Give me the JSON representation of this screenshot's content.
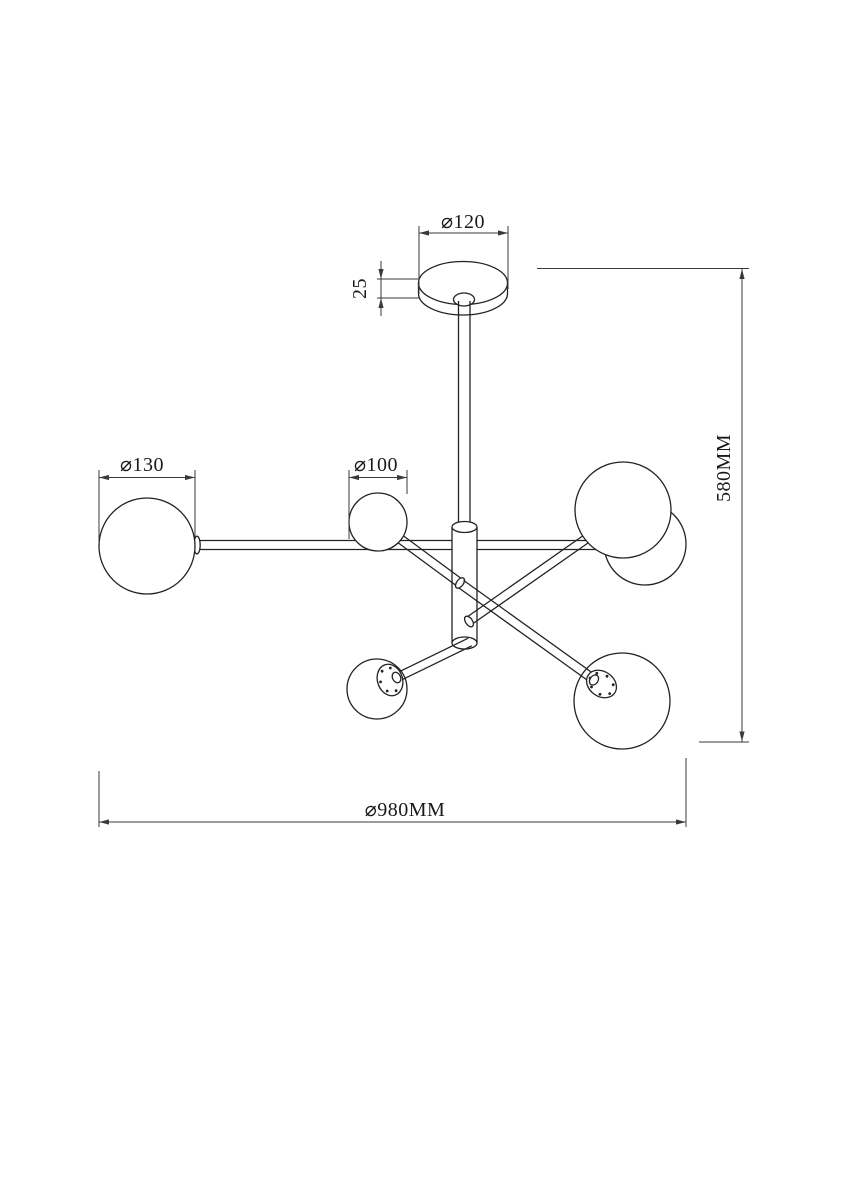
{
  "drawing": {
    "type": "technical-dimension-drawing",
    "subject": "6-globe ceiling chandelier",
    "background_color": "#ffffff",
    "line_color": "#222222",
    "dimension_line_color": "#3a3a3a",
    "labels": {
      "canopy_diameter": "⌀120",
      "canopy_height": "25",
      "large_globe_diameter": "⌀130",
      "small_globe_diameter": "⌀100",
      "overall_height": "580MM",
      "overall_diameter": "⌀980MM"
    }
  }
}
